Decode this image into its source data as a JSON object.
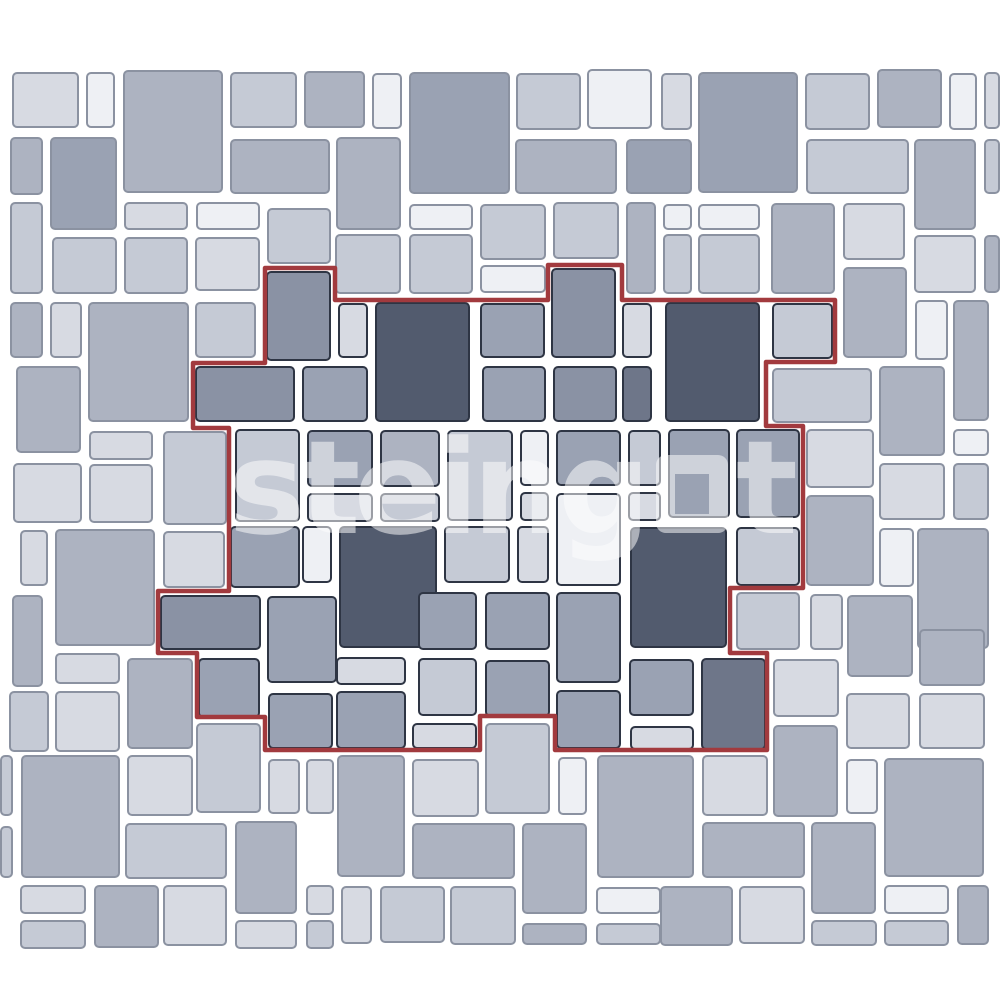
{
  "page": {
    "width": 1000,
    "height": 1000,
    "background": "#ffffff"
  },
  "watermark": {
    "text": "steingot",
    "left": "steing",
    "right": "t",
    "square_glyph": "square-outline",
    "color": "#ffffff",
    "opacity": 0.52
  },
  "pattern": {
    "description": "multi-size paver tile layout with highlighted repeating module",
    "background": "#ffffff",
    "tile_border_outside": "#8b92a1",
    "tile_border_module": "#2e3544",
    "module_outline_color": "#a23a3e",
    "module_outline_points": "265,268 335,268 335,300 548,300 548,265 622,265 622,300 835,300 835,362 766,362 766,426 803,426 803,588 730,588 730,653 767,653 767,750 555,750 555,716 480,716 480,750 265,750 265,717 197,717 197,653 158,653 158,591 229,591 229,428 193,428 193,363 265,363",
    "shades": {
      "xl": "#eef0f4",
      "l": "#d7dae2",
      "lm": "#c5cad5",
      "m": "#adb3c1",
      "mg": "#9aa2b3",
      "md": "#8a92a4",
      "sd": "#6e7689",
      "d": "#525b6e"
    },
    "tiles": [
      [
        12,
        72,
        67,
        56,
        "l",
        0
      ],
      [
        86,
        72,
        29,
        56,
        "xl",
        0
      ],
      [
        123,
        70,
        100,
        123,
        "m",
        0
      ],
      [
        230,
        72,
        67,
        56,
        "lm",
        0
      ],
      [
        304,
        71,
        61,
        57,
        "m",
        0
      ],
      [
        372,
        73,
        30,
        56,
        "xl",
        0
      ],
      [
        409,
        72,
        101,
        122,
        "mg",
        0
      ],
      [
        516,
        73,
        65,
        57,
        "lm",
        0
      ],
      [
        587,
        69,
        65,
        60,
        "xl",
        0
      ],
      [
        661,
        73,
        31,
        57,
        "l",
        0
      ],
      [
        698,
        72,
        100,
        121,
        "mg",
        0
      ],
      [
        805,
        73,
        65,
        57,
        "lm",
        0
      ],
      [
        877,
        69,
        65,
        59,
        "m",
        0
      ],
      [
        949,
        73,
        28,
        57,
        "xl",
        0
      ],
      [
        984,
        72,
        16,
        57,
        "l",
        0
      ],
      [
        10,
        137,
        33,
        58,
        "m",
        0
      ],
      [
        50,
        137,
        67,
        93,
        "mg",
        0
      ],
      [
        230,
        139,
        100,
        55,
        "m",
        0
      ],
      [
        336,
        137,
        65,
        93,
        "m",
        0
      ],
      [
        515,
        139,
        102,
        55,
        "m",
        0
      ],
      [
        626,
        139,
        66,
        55,
        "mg",
        0
      ],
      [
        806,
        139,
        103,
        55,
        "lm",
        0
      ],
      [
        914,
        139,
        62,
        91,
        "m",
        0
      ],
      [
        984,
        139,
        16,
        55,
        "lm",
        0
      ],
      [
        10,
        202,
        33,
        92,
        "lm",
        0
      ],
      [
        124,
        202,
        64,
        28,
        "l",
        0
      ],
      [
        196,
        202,
        64,
        28,
        "xl",
        0
      ],
      [
        52,
        237,
        65,
        57,
        "lm",
        0
      ],
      [
        124,
        237,
        64,
        57,
        "lm",
        0
      ],
      [
        195,
        237,
        65,
        54,
        "l",
        0
      ],
      [
        267,
        208,
        64,
        56,
        "lm",
        0
      ],
      [
        409,
        204,
        64,
        26,
        "xl",
        0
      ],
      [
        480,
        204,
        66,
        56,
        "lm",
        0
      ],
      [
        553,
        202,
        66,
        57,
        "lm",
        0
      ],
      [
        335,
        234,
        66,
        60,
        "lm",
        0
      ],
      [
        409,
        234,
        64,
        60,
        "lm",
        0
      ],
      [
        480,
        265,
        66,
        28,
        "xl",
        0
      ],
      [
        626,
        202,
        30,
        92,
        "m",
        0
      ],
      [
        663,
        204,
        29,
        26,
        "xl",
        0
      ],
      [
        663,
        234,
        29,
        60,
        "lm",
        0
      ],
      [
        698,
        204,
        62,
        26,
        "xl",
        0
      ],
      [
        698,
        234,
        62,
        60,
        "lm",
        0
      ],
      [
        771,
        203,
        64,
        91,
        "m",
        0
      ],
      [
        843,
        203,
        62,
        57,
        "l",
        0
      ],
      [
        914,
        235,
        62,
        58,
        "l",
        0
      ],
      [
        984,
        235,
        16,
        58,
        "m",
        0
      ],
      [
        843,
        267,
        64,
        91,
        "m",
        0
      ],
      [
        915,
        300,
        33,
        60,
        "xl",
        0
      ],
      [
        953,
        300,
        36,
        121,
        "m",
        0
      ],
      [
        10,
        302,
        33,
        56,
        "m",
        0
      ],
      [
        50,
        302,
        32,
        56,
        "l",
        0
      ],
      [
        88,
        302,
        101,
        120,
        "m",
        0
      ],
      [
        195,
        302,
        61,
        56,
        "lm",
        0
      ],
      [
        16,
        366,
        65,
        87,
        "m",
        0
      ],
      [
        266,
        271,
        65,
        90,
        "md",
        1
      ],
      [
        338,
        303,
        30,
        55,
        "l",
        1
      ],
      [
        375,
        302,
        95,
        120,
        "d",
        1
      ],
      [
        480,
        303,
        65,
        55,
        "mg",
        1
      ],
      [
        551,
        268,
        65,
        90,
        "md",
        1
      ],
      [
        622,
        303,
        30,
        55,
        "l",
        1
      ],
      [
        665,
        302,
        95,
        120,
        "d",
        1
      ],
      [
        772,
        303,
        61,
        56,
        "lm",
        1
      ],
      [
        195,
        366,
        100,
        56,
        "md",
        1
      ],
      [
        302,
        366,
        66,
        56,
        "mg",
        1
      ],
      [
        482,
        366,
        64,
        56,
        "mg",
        1
      ],
      [
        553,
        366,
        64,
        56,
        "md",
        1
      ],
      [
        622,
        366,
        30,
        56,
        "sd",
        1
      ],
      [
        235,
        429,
        65,
        93,
        "lm",
        1
      ],
      [
        307,
        430,
        66,
        57,
        "mg",
        1
      ],
      [
        307,
        493,
        66,
        29,
        "l",
        1
      ],
      [
        380,
        430,
        60,
        57,
        "m",
        1
      ],
      [
        380,
        493,
        60,
        29,
        "lm",
        1
      ],
      [
        447,
        430,
        66,
        91,
        "lm",
        1
      ],
      [
        520,
        430,
        29,
        56,
        "xl",
        1
      ],
      [
        520,
        492,
        29,
        29,
        "l",
        1
      ],
      [
        556,
        430,
        65,
        56,
        "mg",
        1
      ],
      [
        556,
        493,
        65,
        93,
        "xl",
        1
      ],
      [
        628,
        430,
        33,
        56,
        "lm",
        1
      ],
      [
        628,
        492,
        33,
        29,
        "l",
        1
      ],
      [
        668,
        429,
        62,
        89,
        "mg",
        1
      ],
      [
        736,
        429,
        64,
        89,
        "mg",
        1
      ],
      [
        230,
        526,
        70,
        62,
        "mg",
        1
      ],
      [
        302,
        526,
        30,
        57,
        "xl",
        1
      ],
      [
        339,
        526,
        98,
        122,
        "d",
        1
      ],
      [
        444,
        526,
        66,
        57,
        "lm",
        1
      ],
      [
        517,
        526,
        32,
        57,
        "l",
        1
      ],
      [
        630,
        527,
        97,
        121,
        "d",
        1
      ],
      [
        736,
        527,
        64,
        59,
        "lm",
        1
      ],
      [
        160,
        595,
        101,
        55,
        "md",
        1
      ],
      [
        267,
        596,
        70,
        87,
        "mg",
        1
      ],
      [
        198,
        658,
        62,
        60,
        "mg",
        1
      ],
      [
        336,
        657,
        70,
        28,
        "l",
        1
      ],
      [
        336,
        691,
        70,
        58,
        "mg",
        1
      ],
      [
        418,
        592,
        59,
        58,
        "mg",
        1
      ],
      [
        485,
        592,
        65,
        58,
        "mg",
        1
      ],
      [
        418,
        658,
        59,
        58,
        "lm",
        1
      ],
      [
        485,
        660,
        65,
        57,
        "mg",
        1
      ],
      [
        556,
        592,
        65,
        91,
        "mg",
        1
      ],
      [
        556,
        690,
        65,
        59,
        "mg",
        1
      ],
      [
        629,
        659,
        65,
        57,
        "mg",
        1
      ],
      [
        630,
        726,
        64,
        24,
        "l",
        1
      ],
      [
        701,
        658,
        65,
        92,
        "sd",
        1
      ],
      [
        412,
        723,
        65,
        26,
        "l",
        1
      ],
      [
        268,
        693,
        65,
        56,
        "mg",
        1
      ],
      [
        772,
        368,
        100,
        55,
        "lm",
        0
      ],
      [
        879,
        366,
        66,
        90,
        "m",
        0
      ],
      [
        806,
        429,
        68,
        59,
        "l",
        0
      ],
      [
        953,
        429,
        36,
        27,
        "xl",
        0
      ],
      [
        953,
        463,
        36,
        57,
        "lm",
        0
      ],
      [
        879,
        463,
        66,
        57,
        "l",
        0
      ],
      [
        806,
        495,
        68,
        91,
        "m",
        0
      ],
      [
        879,
        528,
        35,
        59,
        "xl",
        0
      ],
      [
        917,
        528,
        72,
        121,
        "m",
        0
      ],
      [
        810,
        594,
        33,
        56,
        "l",
        0
      ],
      [
        847,
        595,
        66,
        82,
        "m",
        0
      ],
      [
        919,
        629,
        66,
        57,
        "m",
        0
      ],
      [
        919,
        693,
        66,
        56,
        "l",
        0
      ],
      [
        846,
        693,
        64,
        56,
        "l",
        0
      ],
      [
        736,
        592,
        64,
        58,
        "lm",
        0
      ],
      [
        13,
        463,
        69,
        60,
        "l",
        0
      ],
      [
        89,
        431,
        64,
        29,
        "l",
        0
      ],
      [
        89,
        464,
        64,
        59,
        "l",
        0
      ],
      [
        163,
        431,
        64,
        94,
        "lm",
        0
      ],
      [
        20,
        530,
        28,
        56,
        "l",
        0
      ],
      [
        55,
        529,
        100,
        117,
        "m",
        0
      ],
      [
        163,
        531,
        62,
        57,
        "l",
        0
      ],
      [
        12,
        595,
        31,
        92,
        "m",
        0
      ],
      [
        55,
        653,
        65,
        31,
        "l",
        0
      ],
      [
        55,
        691,
        65,
        61,
        "l",
        0
      ],
      [
        9,
        691,
        40,
        61,
        "lm",
        0
      ],
      [
        127,
        658,
        66,
        91,
        "m",
        0
      ],
      [
        21,
        755,
        99,
        123,
        "m",
        0
      ],
      [
        0,
        755,
        13,
        61,
        "lm",
        0
      ],
      [
        0,
        826,
        13,
        52,
        "lm",
        0
      ],
      [
        127,
        755,
        66,
        61,
        "l",
        0
      ],
      [
        196,
        723,
        65,
        90,
        "lm",
        0
      ],
      [
        125,
        823,
        102,
        56,
        "lm",
        0
      ],
      [
        235,
        821,
        62,
        93,
        "m",
        0
      ],
      [
        268,
        759,
        32,
        55,
        "l",
        0
      ],
      [
        306,
        759,
        28,
        55,
        "l",
        0
      ],
      [
        337,
        755,
        68,
        122,
        "m",
        0
      ],
      [
        412,
        759,
        67,
        58,
        "l",
        0
      ],
      [
        485,
        723,
        65,
        91,
        "lm",
        0
      ],
      [
        558,
        757,
        29,
        58,
        "xl",
        0
      ],
      [
        597,
        755,
        97,
        123,
        "m",
        0
      ],
      [
        412,
        823,
        103,
        56,
        "m",
        0
      ],
      [
        522,
        823,
        65,
        91,
        "m",
        0
      ],
      [
        702,
        755,
        66,
        61,
        "l",
        0
      ],
      [
        773,
        725,
        65,
        92,
        "m",
        0
      ],
      [
        773,
        659,
        66,
        58,
        "l",
        0
      ],
      [
        846,
        759,
        32,
        55,
        "xl",
        0
      ],
      [
        884,
        758,
        100,
        119,
        "m",
        0
      ],
      [
        702,
        822,
        103,
        56,
        "m",
        0
      ],
      [
        811,
        822,
        65,
        92,
        "m",
        0
      ],
      [
        660,
        886,
        73,
        60,
        "m",
        0
      ],
      [
        739,
        886,
        66,
        58,
        "l",
        0
      ],
      [
        811,
        920,
        66,
        26,
        "lm",
        0
      ],
      [
        884,
        885,
        65,
        29,
        "xl",
        0
      ],
      [
        884,
        920,
        65,
        26,
        "lm",
        0
      ],
      [
        957,
        885,
        32,
        60,
        "m",
        0
      ],
      [
        20,
        885,
        66,
        29,
        "l",
        0
      ],
      [
        94,
        885,
        65,
        63,
        "m",
        0
      ],
      [
        163,
        885,
        64,
        61,
        "l",
        0
      ],
      [
        20,
        920,
        66,
        29,
        "lm",
        0
      ],
      [
        235,
        920,
        62,
        29,
        "l",
        0
      ],
      [
        306,
        885,
        28,
        30,
        "l",
        0
      ],
      [
        306,
        920,
        28,
        29,
        "lm",
        0
      ],
      [
        341,
        886,
        31,
        58,
        "l",
        0
      ],
      [
        380,
        886,
        65,
        57,
        "lm",
        0
      ],
      [
        450,
        886,
        66,
        59,
        "lm",
        0
      ],
      [
        522,
        923,
        65,
        22,
        "m",
        0
      ],
      [
        596,
        887,
        65,
        27,
        "xl",
        0
      ],
      [
        596,
        923,
        65,
        22,
        "lm",
        0
      ]
    ]
  }
}
